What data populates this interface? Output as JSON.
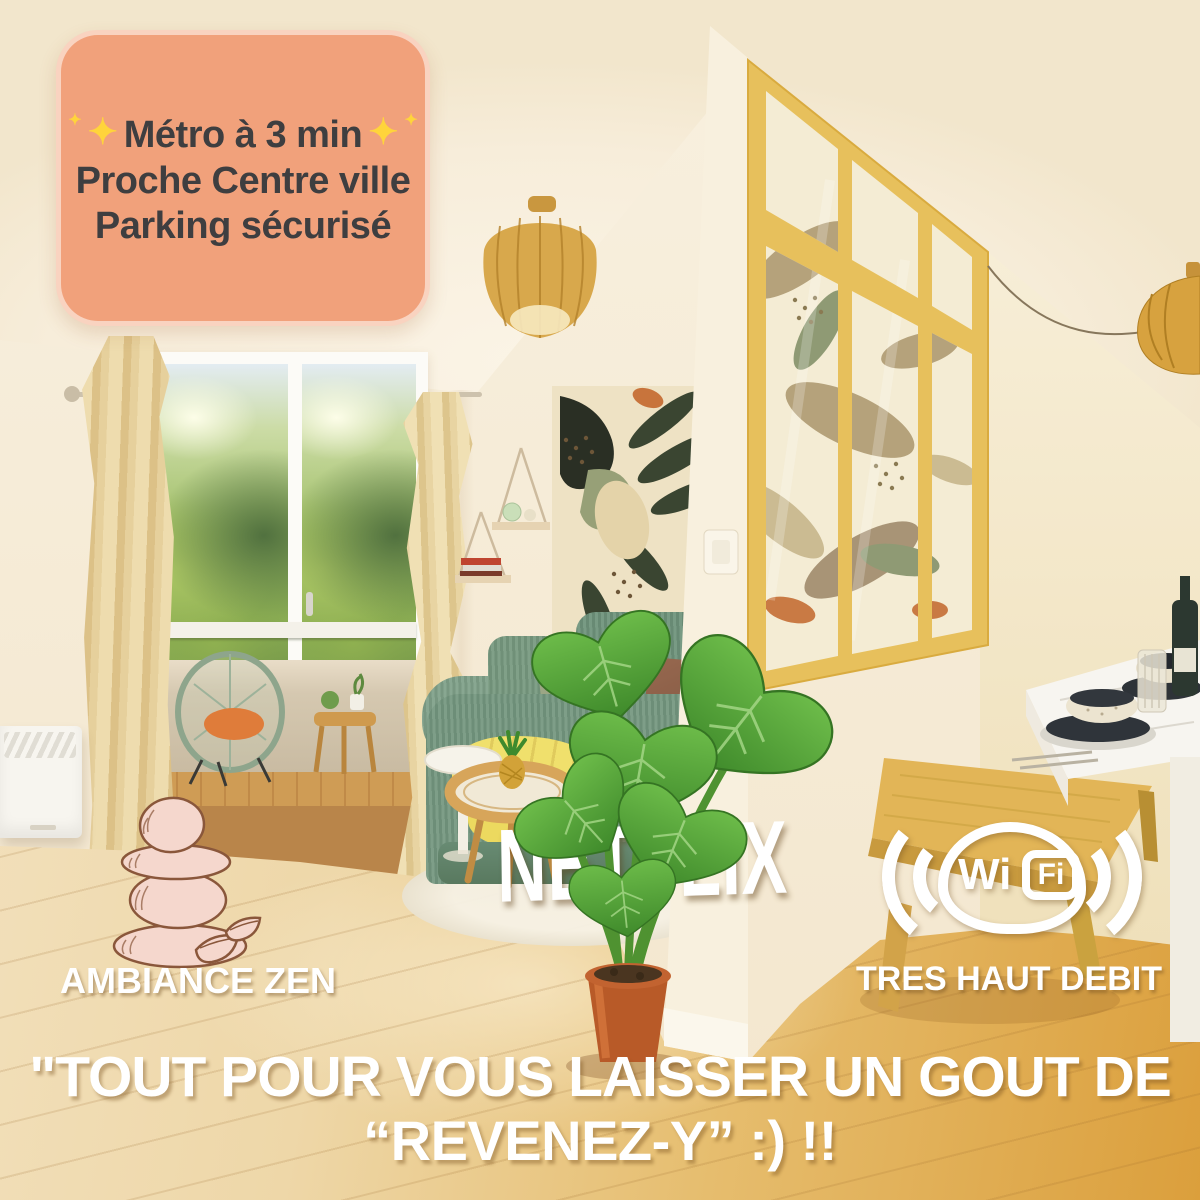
{
  "badge": {
    "lines": [
      "Métro à 3 min",
      "Proche Centre ville",
      "Parking sécurisé"
    ],
    "sparkle": "✦",
    "colors": {
      "background": "#F1A17B",
      "border": "#F8D4C0",
      "text": "#3E3E40",
      "sparkle": "#FFD43B"
    }
  },
  "features": {
    "netflix": "NETFLIX",
    "ambiance_zen": "AMBIANCE ZEN",
    "tres_haut_debit": "TRES HAUT DEBIT",
    "wifi": {
      "wi": "Wi",
      "fi": "Fi"
    },
    "text_color": "#FFFFFF"
  },
  "caption": {
    "line1": "\"TOUT POUR VOUS LAISSER UN GOUT DE",
    "line2": "“REVENEZ-Y” :) !!",
    "color": "#FFFFFF"
  },
  "scene": {
    "subject": "bright apartment living room with balcony, glass partition and dining corner",
    "palette": {
      "wall": "#F5E8D2",
      "ceiling": "#FAF2E2",
      "floor_light": "#F3E2C0",
      "floor_gold": "#DB9F3C",
      "sofa_teal": "#74977F",
      "throw_yellow": "#F0E06C",
      "partition_wood": "#E7C05C",
      "curtain": "#E8D3A0",
      "stones_fill": "#F5D7CD",
      "stones_outline": "#8A573B",
      "plant_green": "#5AA33C",
      "pot_terracotta": "#C26330"
    }
  }
}
